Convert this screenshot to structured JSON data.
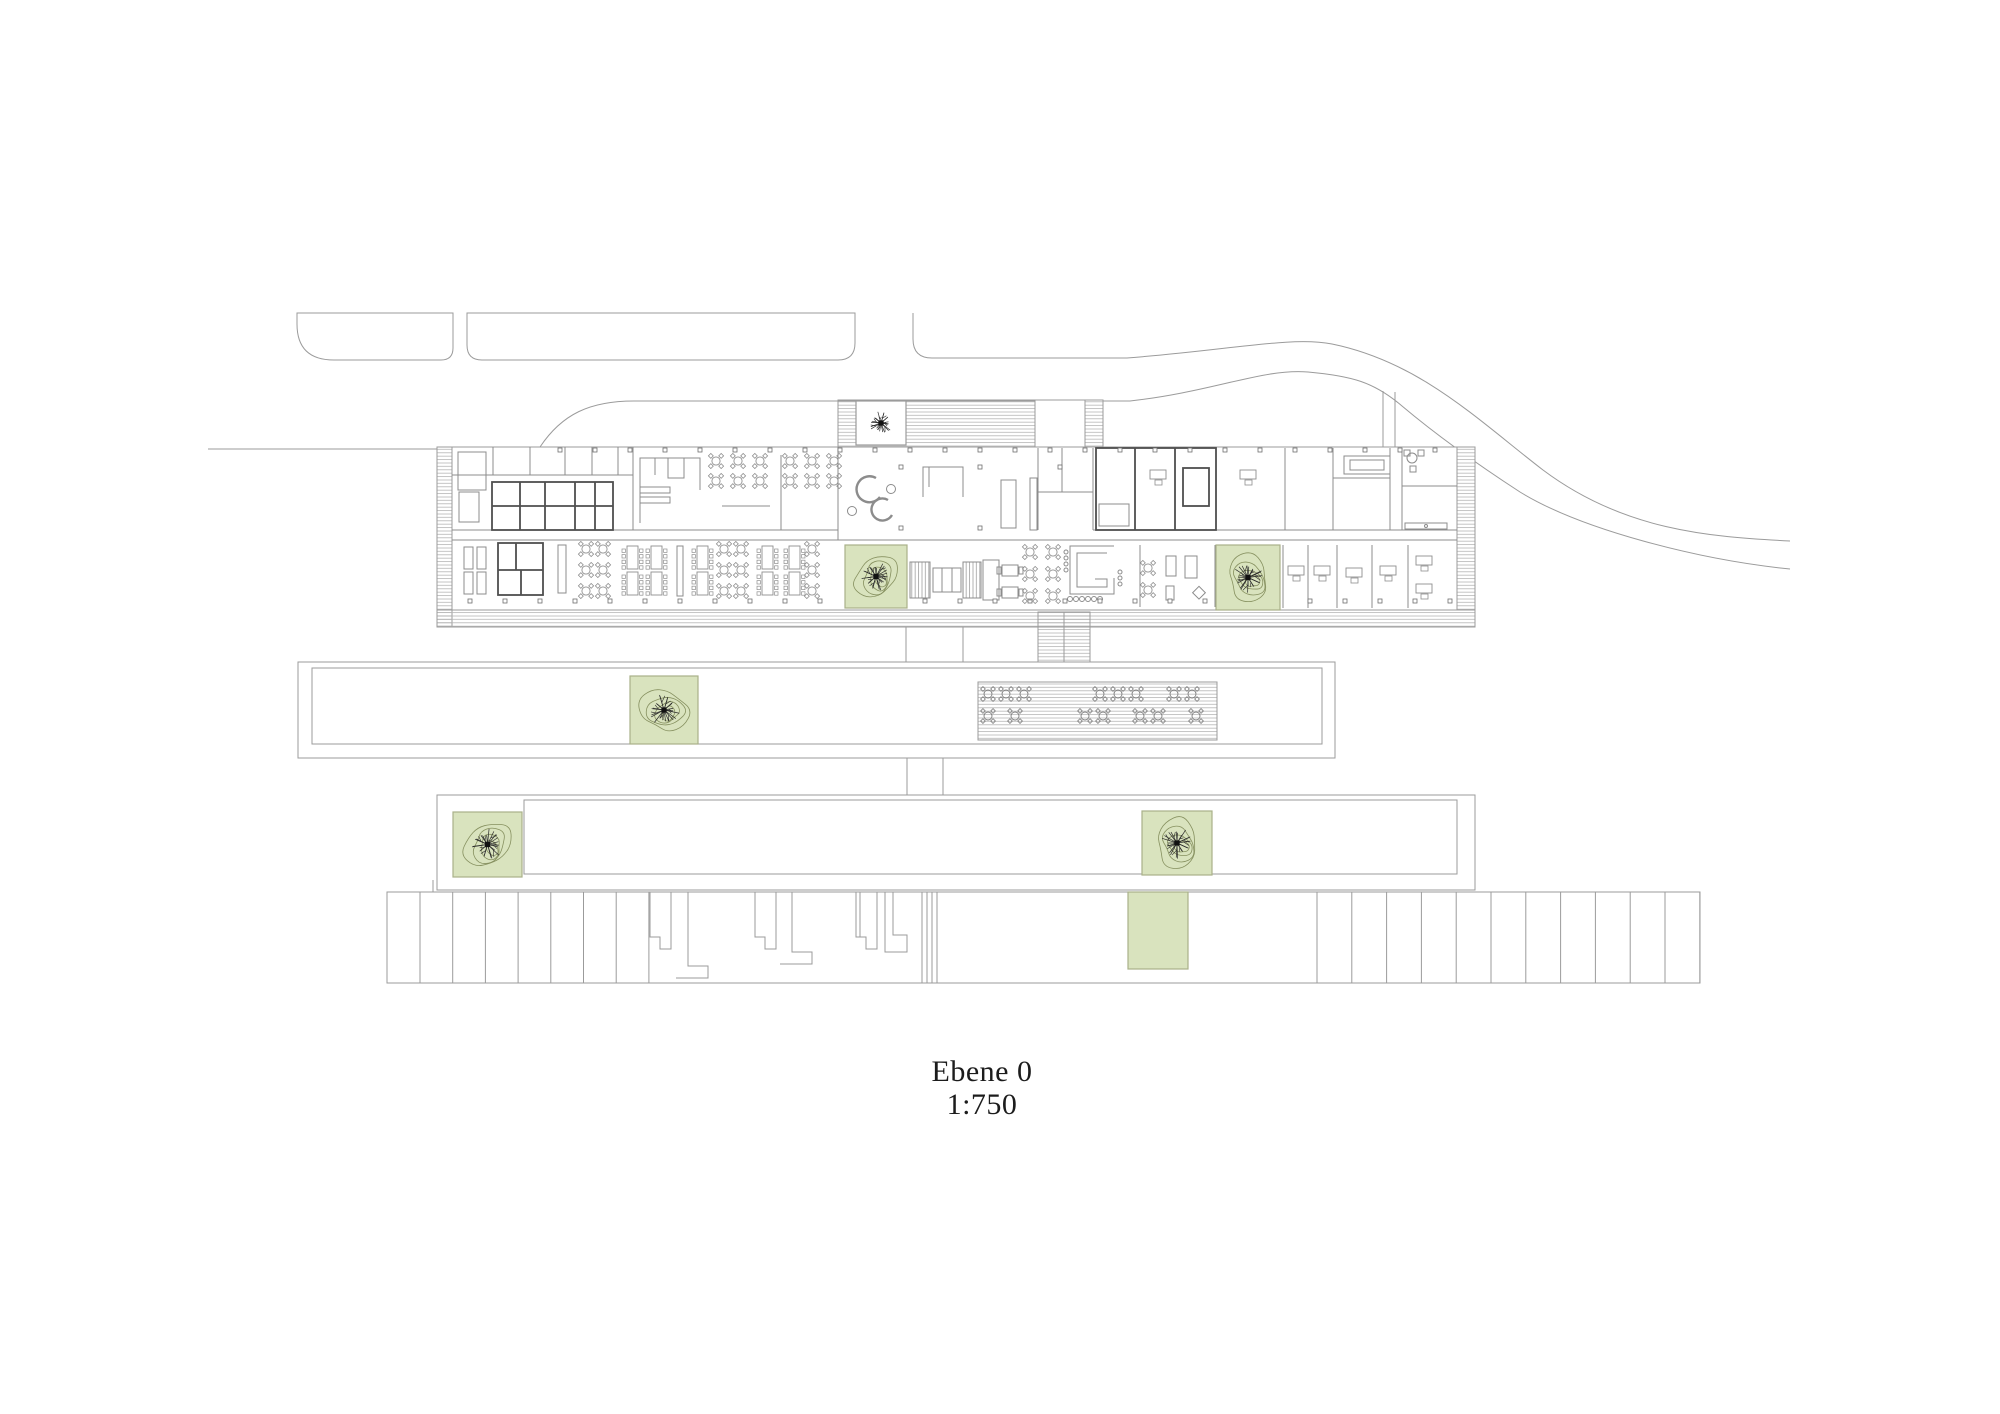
{
  "title_block": {
    "level_label": "Ebene 0",
    "scale_label": "1:750"
  },
  "colors": {
    "green_fill": "#d9e3be",
    "green_border": "#a9b189",
    "contour": "#86905f",
    "line": "#9b9b9b",
    "wall_dark": "#4f4f4f",
    "hatch": "#b5b5b5",
    "tree_stroke": "#2c2c2c",
    "furniture": "#8f8f8f",
    "text": "#1c1c1c"
  },
  "landscape": {
    "green_squares": [
      {
        "name": "plaza-courtyard-tree",
        "x": 856,
        "y": 401,
        "w": 50,
        "h": 44,
        "fill": "white",
        "tree_r": 20,
        "contours": false
      },
      {
        "name": "atrium-tree-west",
        "x": 845,
        "y": 545,
        "w": 62,
        "h": 63,
        "fill": "green",
        "tree_r": 25,
        "contours": true
      },
      {
        "name": "atrium-tree-east",
        "x": 1216,
        "y": 545,
        "w": 64,
        "h": 65,
        "fill": "green",
        "tree_r": 26,
        "contours": true
      },
      {
        "name": "bar2-tree",
        "x": 630,
        "y": 676,
        "w": 68,
        "h": 68,
        "fill": "green",
        "tree_r": 27,
        "contours": true
      },
      {
        "name": "bar3-tree-west",
        "x": 453,
        "y": 812,
        "w": 69,
        "h": 65,
        "fill": "green",
        "tree_r": 27,
        "contours": true
      },
      {
        "name": "bar3-tree-east",
        "x": 1142,
        "y": 811,
        "w": 70,
        "h": 64,
        "fill": "green",
        "tree_r": 27,
        "contours": true
      },
      {
        "name": "parking-green-patch",
        "x": 1128,
        "y": 892,
        "w": 60,
        "h": 77,
        "fill": "green",
        "tree_r": 0,
        "contours": false
      }
    ]
  },
  "columns": {
    "rows": [
      {
        "y": 601,
        "x0": 470,
        "step": 35,
        "n": 29,
        "size": 4
      },
      {
        "y": 450,
        "x0": 560,
        "step": 35,
        "n": 26,
        "size": 4
      }
    ],
    "points": [
      [
        901,
        467
      ],
      [
        901,
        528
      ],
      [
        980,
        467
      ],
      [
        980,
        528
      ],
      [
        1060,
        467
      ]
    ]
  },
  "furniture": {
    "round_clusters": [
      {
        "x": 716,
        "y": 461,
        "cols": 3,
        "rows": 2,
        "px": 22,
        "py": 20
      },
      {
        "x": 790,
        "y": 461,
        "cols": 3,
        "rows": 2,
        "px": 22,
        "py": 20
      },
      {
        "x": 586,
        "y": 549,
        "cols": 2,
        "rows": 3,
        "px": 17,
        "py": 21
      },
      {
        "x": 724,
        "y": 549,
        "cols": 2,
        "rows": 3,
        "px": 17,
        "py": 21
      },
      {
        "x": 812,
        "y": 549,
        "cols": 1,
        "rows": 3,
        "px": 17,
        "py": 21
      },
      {
        "x": 1030,
        "y": 552,
        "cols": 2,
        "rows": 3,
        "px": 23,
        "py": 22
      },
      {
        "x": 1148,
        "y": 568,
        "cols": 1,
        "rows": 2,
        "px": 20,
        "py": 22
      }
    ],
    "long_tables": [
      627,
      651,
      697,
      762,
      789
    ],
    "desks": [
      {
        "x": 1288,
        "y": 566
      },
      {
        "x": 1314,
        "y": 566
      },
      {
        "x": 1346,
        "y": 568
      },
      {
        "x": 1380,
        "y": 566
      },
      {
        "x": 1416,
        "y": 556
      },
      {
        "x": 1416,
        "y": 584
      },
      {
        "x": 1240,
        "y": 470
      },
      {
        "x": 1150,
        "y": 470
      }
    ]
  },
  "terrace": {
    "rows": [
      {
        "y": 694,
        "xs": [
          988,
          1006,
          1024,
          1100,
          1118,
          1136,
          1174,
          1192
        ]
      },
      {
        "y": 716,
        "xs": [
          988,
          1015,
          1085,
          1103,
          1140,
          1158,
          1196
        ]
      }
    ]
  },
  "parking": {
    "top": 892,
    "bottom": 983,
    "groups": [
      {
        "x0": 420,
        "step": 32.7,
        "n": 8
      },
      {
        "x0": 1317,
        "step": 34.8,
        "n": 12
      }
    ]
  }
}
